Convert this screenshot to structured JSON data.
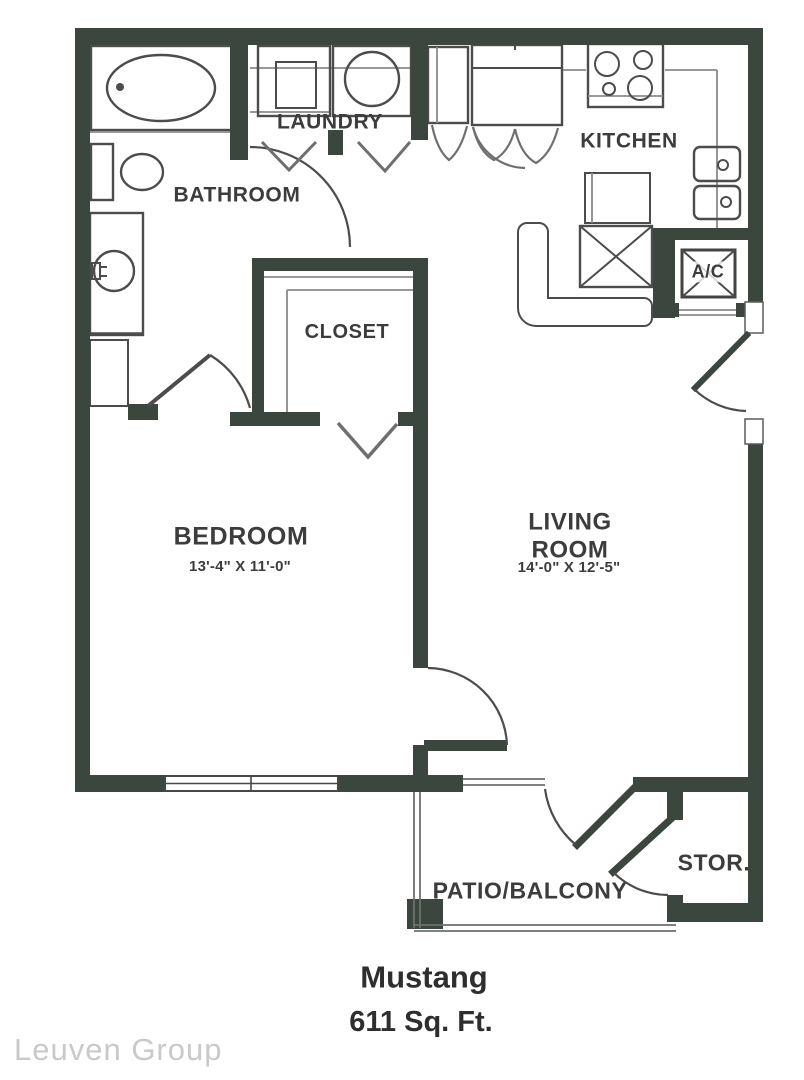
{
  "rooms": {
    "bathroom": {
      "label": "BATHROOM"
    },
    "laundry": {
      "label": "LAUNDRY"
    },
    "kitchen": {
      "label": "KITCHEN"
    },
    "closet": {
      "label": "CLOSET"
    },
    "ac_closet": {
      "label": "A/C"
    },
    "bedroom": {
      "label": "BEDROOM",
      "dimensions": "13'-4\" X 11'-0\""
    },
    "living_room": {
      "label": "LIVING\nROOM",
      "dimensions": "14'-0\" X 12'-5\""
    },
    "patio": {
      "label": "PATIO/BALCONY"
    },
    "storage": {
      "label": "STOR."
    }
  },
  "footer": {
    "title": "Mustang",
    "area": "611 Sq. Ft."
  },
  "watermark": "Leuven Group",
  "colors": {
    "wall": "#3a463e",
    "line": "#4c4c4c",
    "lightline": "#8b8b8b",
    "text": "#3c3c3c",
    "footer": "#2e2e2e",
    "watermark": "#c9c9c9"
  }
}
